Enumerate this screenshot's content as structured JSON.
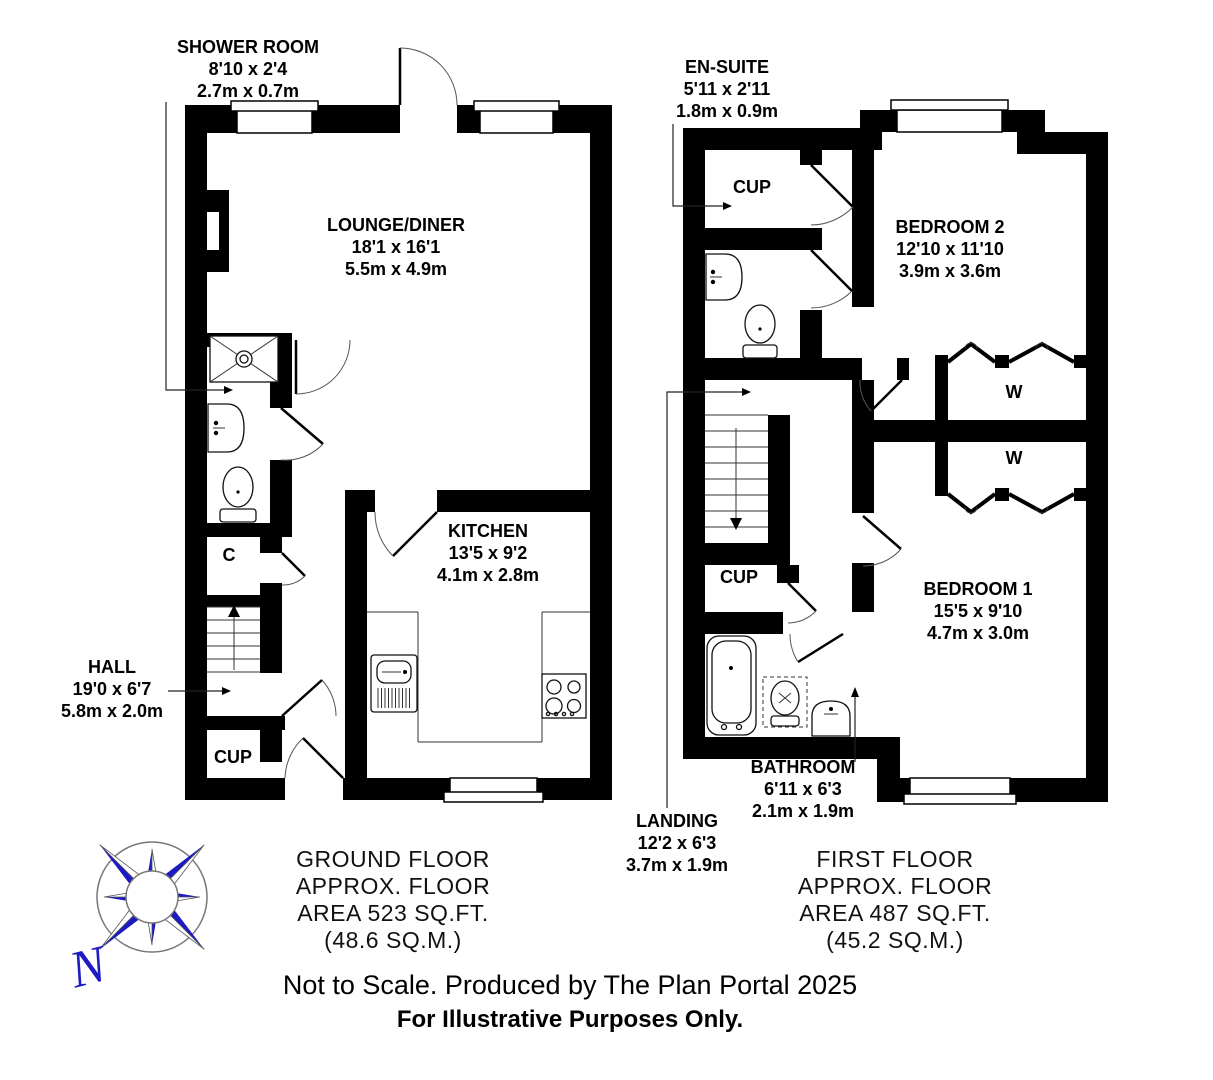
{
  "colors": {
    "wall": "#000000",
    "compass_blue": "#1c1ac2"
  },
  "ground_floor": {
    "rooms": {
      "shower_room": {
        "name": "SHOWER ROOM",
        "size_ft": "8'10 x 2'4",
        "size_m": "2.7m x 0.7m"
      },
      "lounge_diner": {
        "name": "LOUNGE/DINER",
        "size_ft": "18'1 x 16'1",
        "size_m": "5.5m x 4.9m"
      },
      "kitchen": {
        "name": "KITCHEN",
        "size_ft": "13'5 x 9'2",
        "size_m": "4.1m x 2.8m"
      },
      "hall": {
        "name": "HALL",
        "size_ft": "19'0 x 6'7",
        "size_m": "5.8m x 2.0m"
      },
      "cupboard": {
        "name": "CUP"
      },
      "closet": {
        "name": "C"
      }
    },
    "title_lines": [
      "GROUND FLOOR",
      "APPROX. FLOOR",
      "AREA 523 SQ.FT.",
      "(48.6 SQ.M.)"
    ]
  },
  "first_floor": {
    "rooms": {
      "en_suite": {
        "name": "EN-SUITE",
        "size_ft": "5'11 x 2'11",
        "size_m": "1.8m x 0.9m"
      },
      "bedroom_2": {
        "name": "BEDROOM 2",
        "size_ft": "12'10 x 11'10",
        "size_m": "3.9m x 3.6m"
      },
      "bedroom_1": {
        "name": "BEDROOM 1",
        "size_ft": "15'5 x 9'10",
        "size_m": "4.7m x 3.0m"
      },
      "bathroom": {
        "name": "BATHROOM",
        "size_ft": "6'11 x 6'3",
        "size_m": "2.1m x 1.9m"
      },
      "landing": {
        "name": "LANDING",
        "size_ft": "12'2 x 6'3",
        "size_m": "3.7m x 1.9m"
      },
      "cupboard_top": {
        "name": "CUP"
      },
      "cupboard_landing": {
        "name": "CUP"
      },
      "wardrobe_1": {
        "name": "W"
      },
      "wardrobe_2": {
        "name": "W"
      }
    },
    "title_lines": [
      "FIRST FLOOR",
      "APPROX. FLOOR",
      "AREA 487 SQ.FT.",
      "(45.2 SQ.M.)"
    ]
  },
  "compass": {
    "north_label": "N"
  },
  "footer": {
    "disclaimer": "Not to Scale. Produced by The Plan Portal 2025",
    "purpose": "For Illustrative Purposes Only."
  }
}
